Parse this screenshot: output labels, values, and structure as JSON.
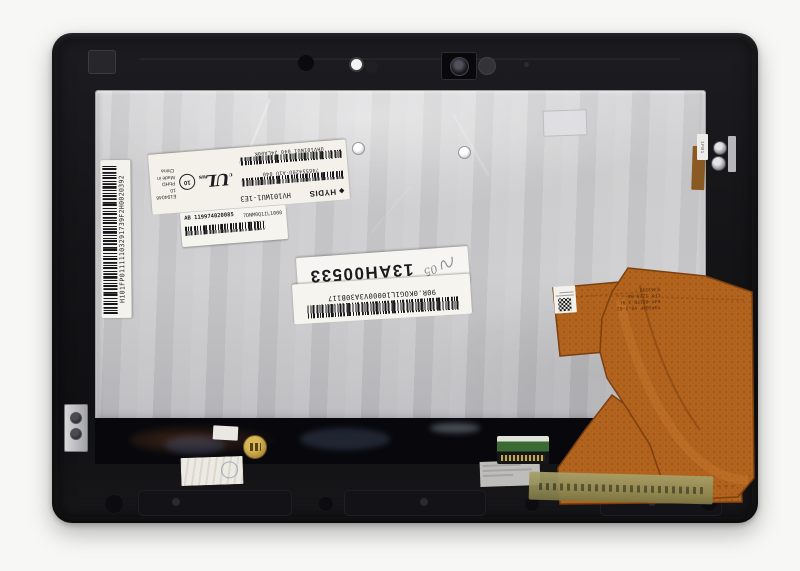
{
  "scene": {
    "description": "Rear view photo of a tablet LCD touchscreen digitizer assembly with orange flex cable",
    "colors": {
      "background": "#f7f7f5",
      "frame": "#17171a",
      "metal_panel": "#c8c8ca",
      "flex_cable": "#b2641f",
      "kapton_tape": "#8b8650",
      "pcb_green": "#3c6a33",
      "gold_sticker": "#b3903a",
      "label_white": "#f4f2ec"
    }
  },
  "labels": {
    "side_serial": "H101FP01111103291739F2H0020392",
    "spec": {
      "brand_mark": "◆",
      "brand": "HYDIS",
      "model": "HV101WU1-1E3",
      "serial_row1": "74655420U-A1U 040",
      "serial_row2": "UHV101WU1 040 24LA00K",
      "ul_small_left": "c",
      "ul_mark": "UL",
      "ul_small_right": "us",
      "recycle_number": "10",
      "reg_line1": "E194046",
      "reg_line2": "10 PbHD",
      "reg_line3": "Made in China"
    },
    "inventory": {
      "code_left": "AB 119974020085",
      "code_right": "7DNM0Q1IL1000"
    },
    "batch_stamp": "13AH00533",
    "handwritten_mark": "05",
    "part_number": "90R.0KOG1L10000V3A30B117",
    "bracket_tag": "1FB1",
    "flex_print": {
      "line1": "TOPSO4F V0.2-02",
      "line2": "64Y-0Q1FB-3 9L",
      "line3": "LFX 1228.08",
      "line4": "E343393"
    }
  }
}
